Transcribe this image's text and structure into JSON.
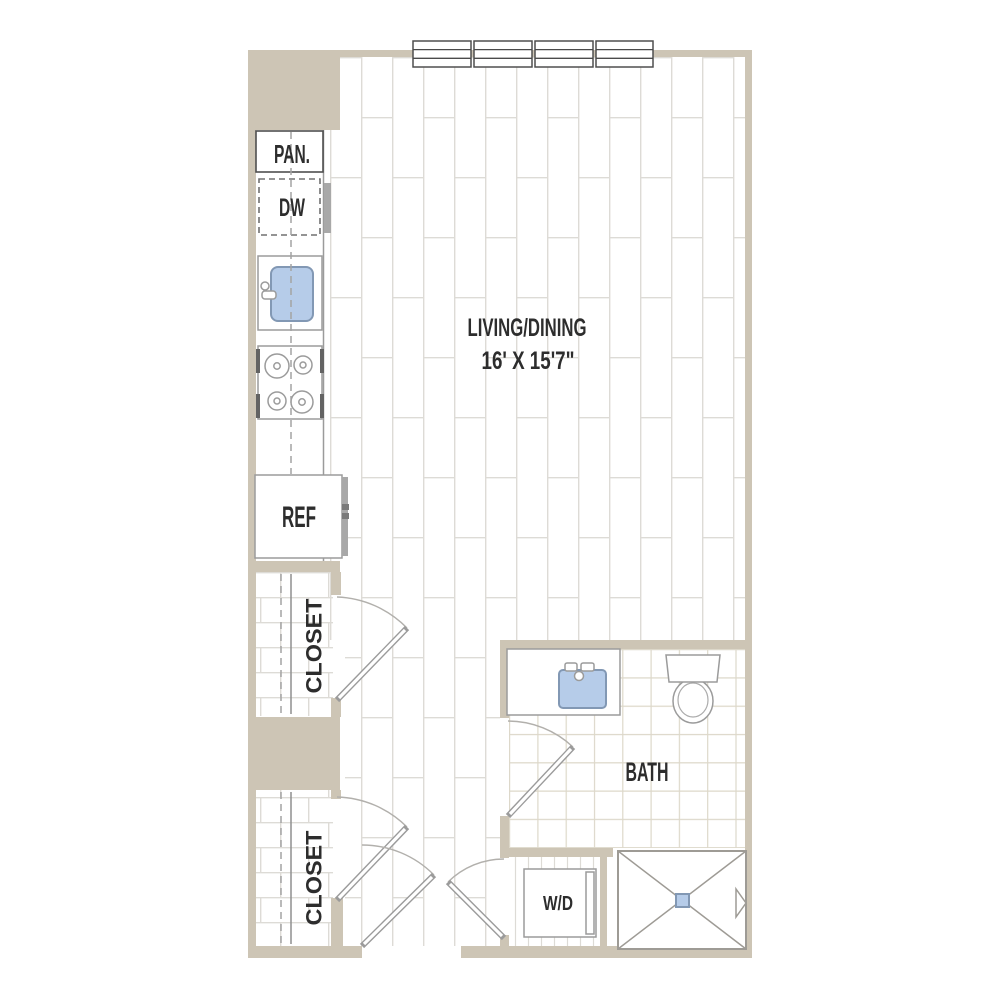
{
  "plan": {
    "type": "apartment-floor-plan",
    "labels": {
      "pantry": "PAN.",
      "dishwasher": "DW",
      "refrigerator": "REF",
      "upper_closet": "CLOSET",
      "lower_closet": "CLOSET",
      "living_dining": "LIVING/DINING",
      "living_dining_size": "16' X 15'7\"",
      "bath": "BATH",
      "washer_dryer": "W/D"
    },
    "windows": {
      "count": 4
    },
    "colors": {
      "wall": "#cdc5b5",
      "plank_line": "#dddbd6",
      "tile_line": "#ddd8ca",
      "fixture_outline": "#9b9b9b",
      "dark_outline": "#4f4f4f",
      "door_arc": "#b2b0ac",
      "fixture_blue": "#b6cce9",
      "fixture_blue_border": "#8298b4",
      "text": "#2d2d2d"
    }
  }
}
